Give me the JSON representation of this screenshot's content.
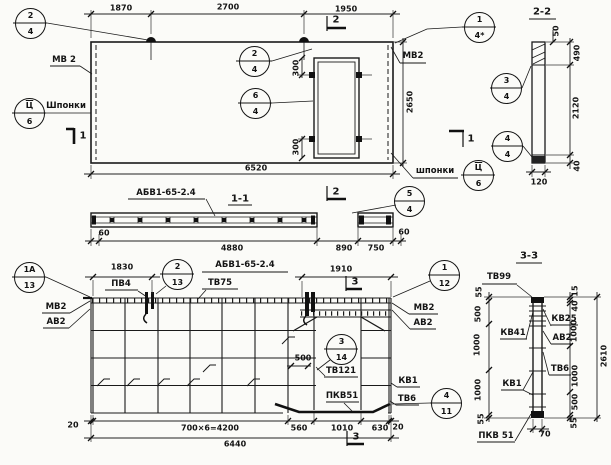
{
  "callouts": [
    {
      "top": "2",
      "bottom": "4"
    },
    {
      "top": "Ц",
      "bottom": "6"
    },
    {
      "top": "2",
      "bottom": "4"
    },
    {
      "top": "6",
      "bottom": "4"
    },
    {
      "top": "1",
      "bottom": "4*"
    },
    {
      "top": "Ц",
      "bottom": "6"
    },
    {
      "top": "3",
      "bottom": "4"
    },
    {
      "top": "4",
      "bottom": "4"
    },
    {
      "top": "5",
      "bottom": "4"
    },
    {
      "top": "1А",
      "bottom": "13"
    },
    {
      "top": "2",
      "bottom": "13"
    },
    {
      "top": "1",
      "bottom": "12"
    },
    {
      "top": "3",
      "bottom": "14"
    },
    {
      "top": "4",
      "bottom": "11"
    }
  ],
  "elevation": {
    "dims_top": [
      "1870",
      "2700",
      "1950"
    ],
    "dim_length": "6520",
    "dim_height": "2650",
    "dim_door_top": "300",
    "dim_door_bottom": "300",
    "label_mv2_left": "МВ 2",
    "label_keys_left": "Шпонки",
    "label_mv2_right": "МВ2",
    "label_keys_right": "шпонки",
    "mark": "АБВ1-65-2.4",
    "marker_top": "2",
    "marker_bottom": "2",
    "marker_left": "1",
    "marker_right": "1"
  },
  "section_1_1": {
    "title": "1-1",
    "dims": [
      "60",
      "4880",
      "890",
      "750",
      "60"
    ]
  },
  "section_2_2": {
    "title": "2-2",
    "dim_50": "50",
    "dim_490": "490",
    "dim_2120": "2120",
    "dim_40": "40",
    "dim_120": "120"
  },
  "plan": {
    "title": "АБВ1-65-2.4",
    "dim_1830": "1830",
    "dim_1910": "1910",
    "dim_500": "500",
    "labels": {
      "pv4": "ПВ4",
      "tv75": "ТВ75",
      "mv2_left": "МВ2",
      "av2_left": "АВ2",
      "mv2_right": "МВ2",
      "av2_right": "АВ2",
      "tv121": "ТВ121",
      "kv1": "КВ1",
      "pkv51": "ПКВ51",
      "tv6": "ТВ6"
    },
    "dims_bottom": [
      "20",
      "700×6=4200",
      "560",
      "1010",
      "630",
      "20"
    ],
    "dim_total": "6440",
    "marker_top": "3",
    "marker_bottom": "3"
  },
  "section_3_3": {
    "title": "3-3",
    "labels": {
      "tv99": "ТВ99",
      "kv41": "КВ41",
      "kv1": "КВ1",
      "pkv51": "ПКВ 51",
      "kv25": "КВ25",
      "av2": "АВ2",
      "tv6": "ТВ6"
    },
    "dims_left": [
      "55",
      "500",
      "1000",
      "1000",
      "55"
    ],
    "dims_right": [
      "15",
      "40",
      "1000",
      "1000",
      "500",
      "55"
    ],
    "dim_total": "2610",
    "dim_width": "70"
  }
}
